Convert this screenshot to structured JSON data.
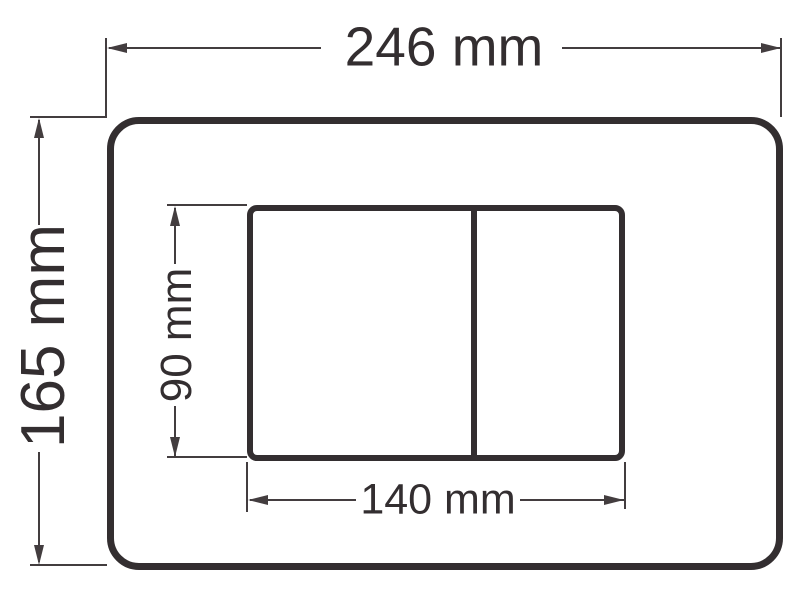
{
  "diagram": {
    "kind": "technical dimension drawing",
    "background_color": "#ffffff",
    "stroke_color": "#332e30",
    "dimensions": {
      "plate_width": {
        "label": "246 mm",
        "value": 246,
        "unit": "mm"
      },
      "plate_height": {
        "label": "165 mm",
        "value": 165,
        "unit": "mm"
      },
      "button_width": {
        "label": "140 mm",
        "value": 140,
        "unit": "mm"
      },
      "button_height": {
        "label": "90 mm",
        "value": 90,
        "unit": "mm"
      }
    }
  }
}
